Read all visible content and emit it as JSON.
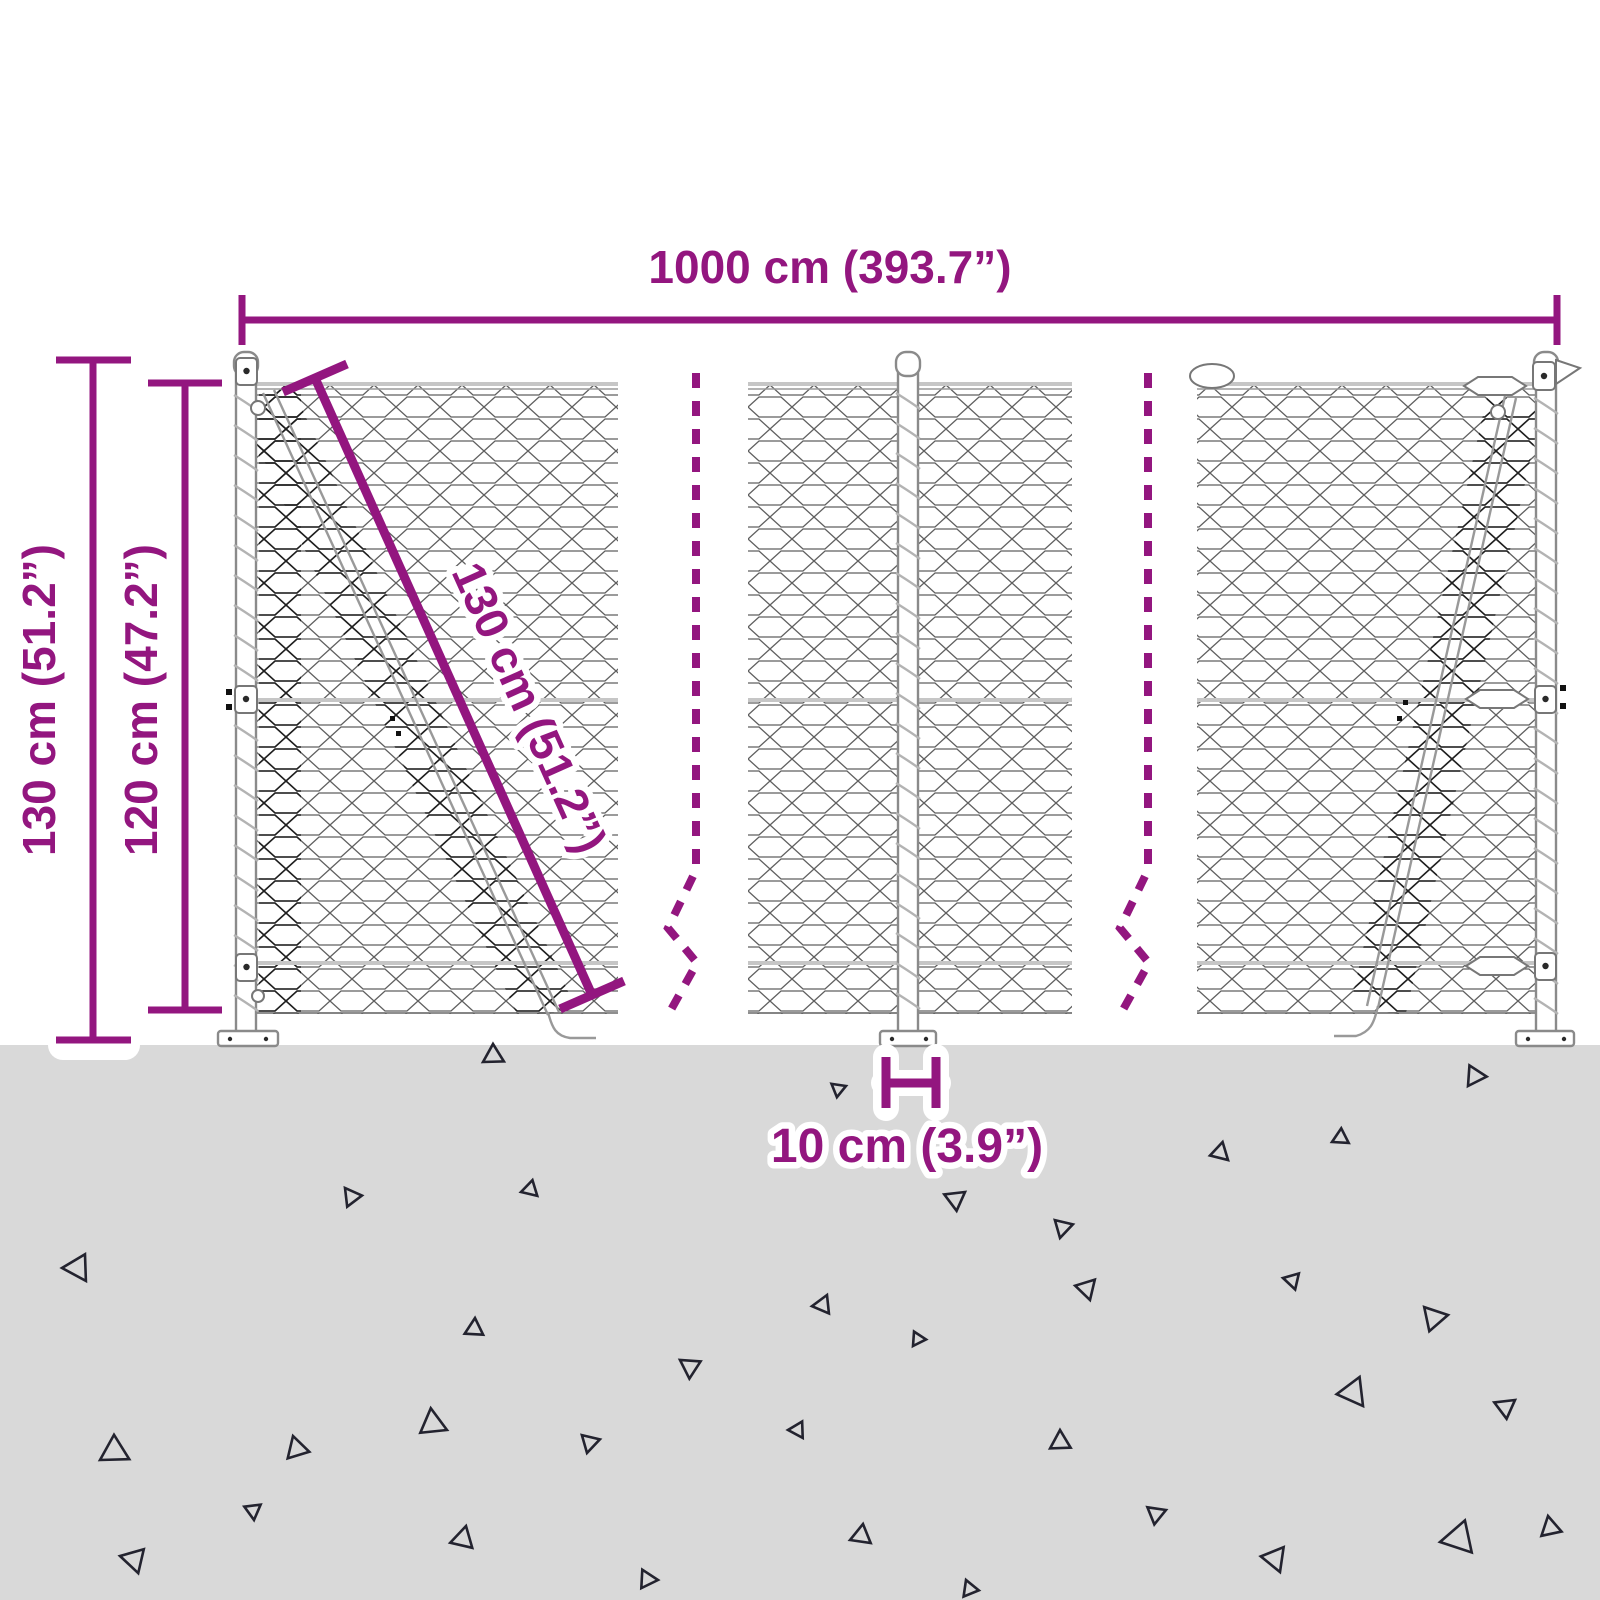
{
  "title": "Chain-link fence dimension diagram",
  "colors": {
    "accent": "#93167f",
    "ground": "#d9d9d9",
    "triangle": "#23232f",
    "mesh": "#5f5f5f",
    "meshdark": "#1f1f1f",
    "rail": "#c6c6c6",
    "poststroke": "#8a8a8a"
  },
  "labels": {
    "total_width": "1000 cm (393.7”)",
    "total_height": "130 cm (51.2”)",
    "mesh_height": "120 cm (47.2”)",
    "diagonal_length": "130 cm (51.2”)",
    "post_ground_distance": "10 cm (3.9”)"
  },
  "decorations": {
    "ground_triangles": [
      {
        "x": 483,
        "y": 1062,
        "s": 20,
        "r": 15
      },
      {
        "x": 846,
        "y": 1086,
        "s": 14,
        "r": 205
      },
      {
        "x": 1468,
        "y": 1086,
        "s": 20,
        "r": 350
      },
      {
        "x": 345,
        "y": 1188,
        "s": 18,
        "r": 100
      },
      {
        "x": 521,
        "y": 1192,
        "s": 16,
        "r": 30
      },
      {
        "x": 1228,
        "y": 1160,
        "s": 18,
        "r": 270
      },
      {
        "x": 1332,
        "y": 1142,
        "s": 16,
        "r": 20
      },
      {
        "x": 965,
        "y": 1192,
        "s": 20,
        "r": 190
      },
      {
        "x": 62,
        "y": 1268,
        "s": 26,
        "r": 45
      },
      {
        "x": 1060,
        "y": 1238,
        "s": 18,
        "r": 330
      },
      {
        "x": 475,
        "y": 1318,
        "s": 18,
        "r": 140
      },
      {
        "x": 827,
        "y": 1295,
        "s": 18,
        "r": 160
      },
      {
        "x": 1090,
        "y": 1300,
        "s": 20,
        "r": 300
      },
      {
        "x": 1283,
        "y": 1278,
        "s": 16,
        "r": 60
      },
      {
        "x": 1448,
        "y": 1315,
        "s": 24,
        "r": 215
      },
      {
        "x": 680,
        "y": 1360,
        "s": 20,
        "r": 80
      },
      {
        "x": 913,
        "y": 1346,
        "s": 14,
        "r": 350
      },
      {
        "x": 100,
        "y": 1460,
        "s": 28,
        "r": 15
      },
      {
        "x": 293,
        "y": 1436,
        "s": 22,
        "r": 120
      },
      {
        "x": 447,
        "y": 1430,
        "s": 26,
        "r": 250
      },
      {
        "x": 587,
        "y": 1453,
        "s": 18,
        "r": 330
      },
      {
        "x": 788,
        "y": 1430,
        "s": 16,
        "r": 45
      },
      {
        "x": 1060,
        "y": 1430,
        "s": 20,
        "r": 135
      },
      {
        "x": 1363,
        "y": 1406,
        "s": 28,
        "r": 280
      },
      {
        "x": 1515,
        "y": 1400,
        "s": 20,
        "r": 190
      },
      {
        "x": 120,
        "y": 1556,
        "s": 24,
        "r": 60
      },
      {
        "x": 254,
        "y": 1520,
        "s": 16,
        "r": 310
      },
      {
        "x": 466,
        "y": 1526,
        "s": 22,
        "r": 150
      },
      {
        "x": 658,
        "y": 1580,
        "s": 18,
        "r": 230
      },
      {
        "x": 850,
        "y": 1540,
        "s": 20,
        "r": 25
      },
      {
        "x": 966,
        "y": 1580,
        "s": 16,
        "r": 115
      },
      {
        "x": 1166,
        "y": 1510,
        "s": 18,
        "r": 205
      },
      {
        "x": 1280,
        "y": 1572,
        "s": 24,
        "r": 295
      },
      {
        "x": 1440,
        "y": 1542,
        "s": 32,
        "r": 35
      },
      {
        "x": 1548,
        "y": 1516,
        "s": 20,
        "r": 125
      }
    ],
    "posts": [
      {
        "cx": 246,
        "top": 395,
        "bottom": 1005
      },
      {
        "cx": 908,
        "top": 393,
        "bottom": 1005
      },
      {
        "cx": 1546,
        "top": 398,
        "bottom": 1000
      }
    ]
  }
}
